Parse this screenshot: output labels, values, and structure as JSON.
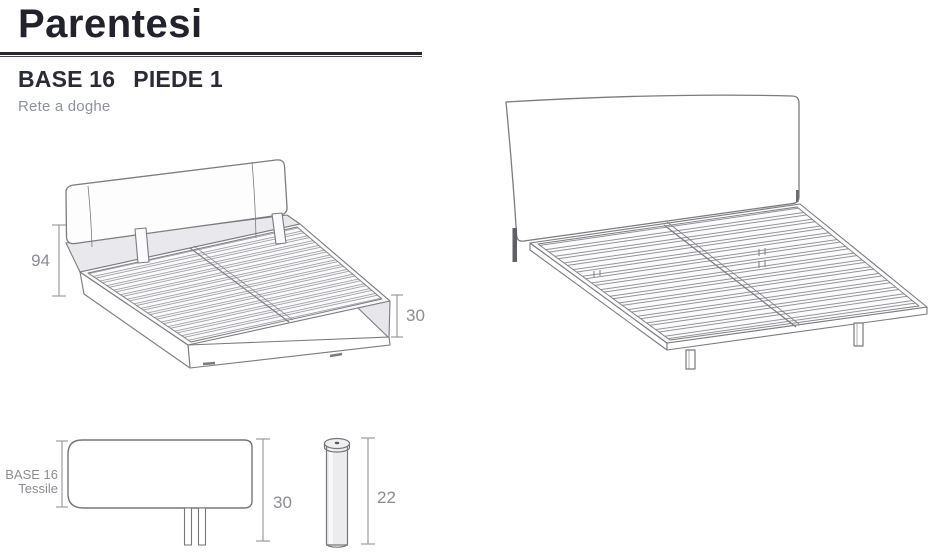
{
  "header": {
    "title": "Parentesi",
    "model": "BASE 16",
    "variant": "PIEDE 1",
    "subtitle": "Rete a doghe"
  },
  "dimensions": {
    "headboard_height": "94",
    "base_side_height": "30",
    "base_total_height": "30",
    "leg_height": "22"
  },
  "labels": {
    "base_name": "BASE 16",
    "base_finish": "Tessile"
  },
  "colors": {
    "ink": "#22222c",
    "rule": "#26262e",
    "drawing_line": "#7b7b80",
    "dim_text": "#8c8c94",
    "gray_fill": "#e8e8ec",
    "subtitle": "#8f929c"
  }
}
